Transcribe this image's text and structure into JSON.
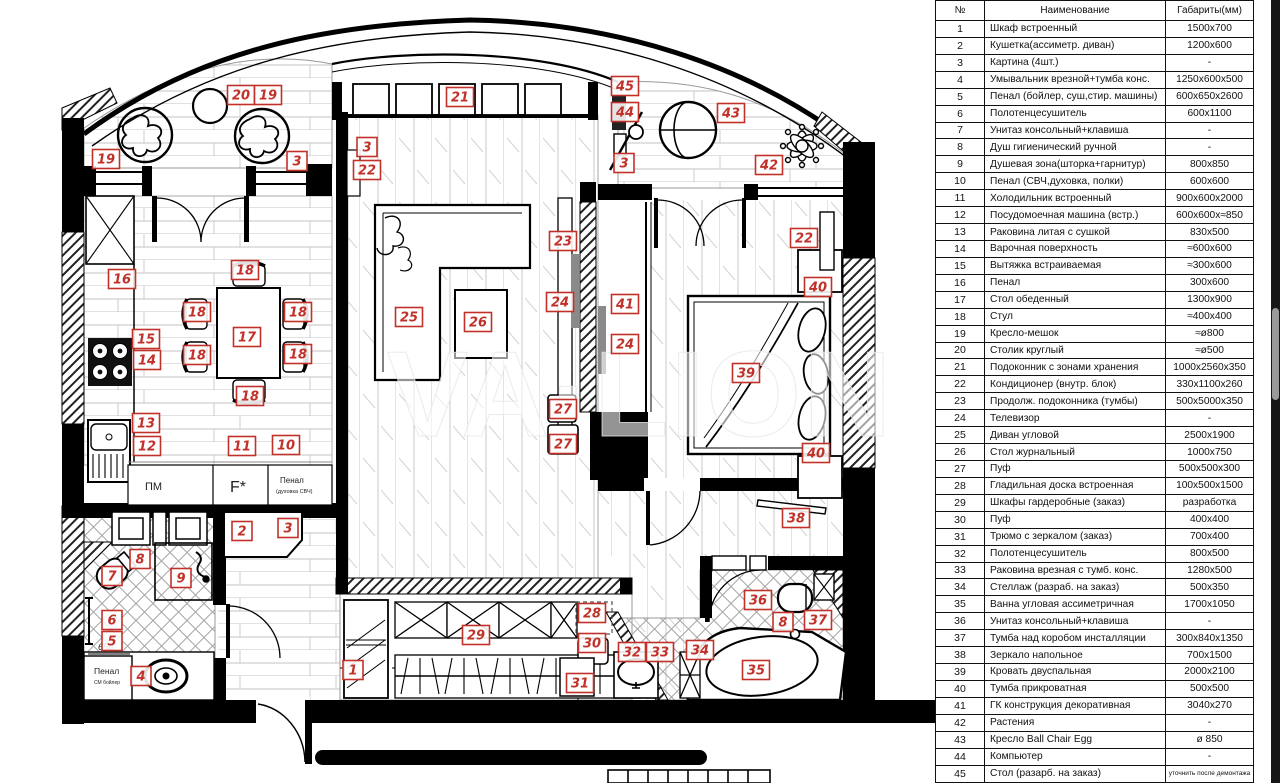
{
  "watermark": "VA·LION",
  "table": {
    "headers": [
      "№",
      "Наименование",
      "Габариты(мм)"
    ],
    "rows": [
      {
        "num": "1",
        "name": "Шкаф встроенный",
        "dim": "1500x700"
      },
      {
        "num": "2",
        "name": "Кушетка(ассиметр. диван)",
        "dim": "1200x600"
      },
      {
        "num": "3",
        "name": "Картина (4шт.)",
        "dim": "-"
      },
      {
        "num": "4",
        "name": "Умывальник врезной+тумба конс.",
        "dim": "1250x600x500"
      },
      {
        "num": "5",
        "name": "Пенал (бойлер, суш,стир. машины)",
        "dim": "600x650x2600"
      },
      {
        "num": "6",
        "name": "Полотенцесушитель",
        "dim": "600x1100"
      },
      {
        "num": "7",
        "name": "Унитаз консольный+клавиша",
        "dim": "-"
      },
      {
        "num": "8",
        "name": "Душ гигиенический ручной",
        "dim": "-"
      },
      {
        "num": "9",
        "name": "Душевая зона(шторка+гарнитур)",
        "dim": "800x850"
      },
      {
        "num": "10",
        "name": "Пенал (СВЧ,духовка, полки)",
        "dim": "600x600"
      },
      {
        "num": "11",
        "name": "Холодильник  встроенный",
        "dim": "900x600x2000"
      },
      {
        "num": "12",
        "name": "Посудомоечная машина (встр.)",
        "dim": "600x600x≈850"
      },
      {
        "num": "13",
        "name": "Раковина литая с сушкой",
        "dim": "830x500"
      },
      {
        "num": "14",
        "name": "Варочная поверхность",
        "dim": "≈600x600"
      },
      {
        "num": "15",
        "name": "Вытяжка встраиваемая",
        "dim": "≈300x600"
      },
      {
        "num": "16",
        "name": "Пенал",
        "dim": "300x600"
      },
      {
        "num": "17",
        "name": "Стол обеденный",
        "dim": "1300x900"
      },
      {
        "num": "18",
        "name": "Стул",
        "dim": "≈400x400"
      },
      {
        "num": "19",
        "name": "Кресло-мешок",
        "dim": "≈ø800"
      },
      {
        "num": "20",
        "name": "Столик круглый",
        "dim": "≈ø500"
      },
      {
        "num": "21",
        "name": "Подоконник с зонами хранения",
        "dim": "1000x2560x350"
      },
      {
        "num": "22",
        "name": "Кондиционер (внутр. блок)",
        "dim": "330x1100x260"
      },
      {
        "num": "23",
        "name": "Продолж. подоконника (тумбы)",
        "dim": "500x5000x350"
      },
      {
        "num": "24",
        "name": "Телевизор",
        "dim": "-"
      },
      {
        "num": "25",
        "name": "Диван угловой",
        "dim": "2500x1900"
      },
      {
        "num": "26",
        "name": "Стол журнальный",
        "dim": "1000x750"
      },
      {
        "num": "27",
        "name": "Пуф",
        "dim": "500x500x300"
      },
      {
        "num": "28",
        "name": "Гладильная доска встроенная",
        "dim": "100x500x1500"
      },
      {
        "num": "29",
        "name": "Шкафы гардеробные (заказ)",
        "dim": "разработка"
      },
      {
        "num": "30",
        "name": "Пуф",
        "dim": "400x400"
      },
      {
        "num": "31",
        "name": "Трюмо с зеркалом (заказ)",
        "dim": "700x400"
      },
      {
        "num": "32",
        "name": "Полотенцесушитель",
        "dim": "800x500"
      },
      {
        "num": "33",
        "name": "Раковина врезная с тумб. конс.",
        "dim": "1280x500"
      },
      {
        "num": "34",
        "name": "Стеллаж (разраб. на заказ)",
        "dim": "500x350"
      },
      {
        "num": "35",
        "name": "Ванна угловая ассиметричная",
        "dim": "1700x1050"
      },
      {
        "num": "36",
        "name": "Унитаз консольный+клавиша",
        "dim": "-"
      },
      {
        "num": "37",
        "name": "Тумба над коробом инсталляции",
        "dim": "300x840x1350"
      },
      {
        "num": "38",
        "name": "Зеркало напольное",
        "dim": "700x1500"
      },
      {
        "num": "39",
        "name": "Кровать двуспальная",
        "dim": "2000x2100"
      },
      {
        "num": "40",
        "name": "Тумба прикроватная",
        "dim": "500x500"
      },
      {
        "num": "41",
        "name": "ГК конструкция декоративная",
        "dim": "3040x270"
      },
      {
        "num": "42",
        "name": "Растения",
        "dim": "-"
      },
      {
        "num": "43",
        "name": "Кресло Ball Chair Egg",
        "dim": "ø 850"
      },
      {
        "num": "44",
        "name": "Компьютер",
        "dim": "-"
      },
      {
        "num": "45",
        "name": "Стол (разарб. на заказ)",
        "dim": "уточнить после демонтажа"
      }
    ]
  },
  "plan": {
    "labels": [
      {
        "n": "19",
        "x": 106,
        "y": 159
      },
      {
        "n": "20",
        "x": 241,
        "y": 95
      },
      {
        "n": "19",
        "x": 268,
        "y": 95
      },
      {
        "n": "3",
        "x": 297,
        "y": 161
      },
      {
        "n": "3",
        "x": 367,
        "y": 147
      },
      {
        "n": "22",
        "x": 367,
        "y": 170
      },
      {
        "n": "21",
        "x": 460,
        "y": 97
      },
      {
        "n": "45",
        "x": 625,
        "y": 86
      },
      {
        "n": "44",
        "x": 625,
        "y": 112
      },
      {
        "n": "3",
        "x": 624,
        "y": 163
      },
      {
        "n": "43",
        "x": 731,
        "y": 113
      },
      {
        "n": "42",
        "x": 769,
        "y": 165
      },
      {
        "n": "22",
        "x": 804,
        "y": 238
      },
      {
        "n": "23",
        "x": 563,
        "y": 241
      },
      {
        "n": "40",
        "x": 818,
        "y": 287
      },
      {
        "n": "16",
        "x": 122,
        "y": 279
      },
      {
        "n": "18",
        "x": 245,
        "y": 270
      },
      {
        "n": "18",
        "x": 197,
        "y": 312
      },
      {
        "n": "18",
        "x": 298,
        "y": 312
      },
      {
        "n": "17",
        "x": 247,
        "y": 337
      },
      {
        "n": "15",
        "x": 146,
        "y": 339
      },
      {
        "n": "14",
        "x": 147,
        "y": 360
      },
      {
        "n": "18",
        "x": 197,
        "y": 355
      },
      {
        "n": "18",
        "x": 298,
        "y": 354
      },
      {
        "n": "18",
        "x": 250,
        "y": 396
      },
      {
        "n": "13",
        "x": 146,
        "y": 423
      },
      {
        "n": "12",
        "x": 147,
        "y": 446
      },
      {
        "n": "11",
        "x": 242,
        "y": 446
      },
      {
        "n": "10",
        "x": 286,
        "y": 445
      },
      {
        "n": "25",
        "x": 409,
        "y": 317
      },
      {
        "n": "26",
        "x": 478,
        "y": 322
      },
      {
        "n": "24",
        "x": 560,
        "y": 302
      },
      {
        "n": "41",
        "x": 625,
        "y": 304
      },
      {
        "n": "24",
        "x": 625,
        "y": 344
      },
      {
        "n": "27",
        "x": 563,
        "y": 409
      },
      {
        "n": "27",
        "x": 563,
        "y": 444
      },
      {
        "n": "39",
        "x": 746,
        "y": 373
      },
      {
        "n": "40",
        "x": 816,
        "y": 453
      },
      {
        "n": "38",
        "x": 796,
        "y": 518
      },
      {
        "n": "2",
        "x": 242,
        "y": 531
      },
      {
        "n": "3",
        "x": 288,
        "y": 528
      },
      {
        "n": "8",
        "x": 140,
        "y": 559
      },
      {
        "n": "7",
        "x": 112,
        "y": 576
      },
      {
        "n": "9",
        "x": 181,
        "y": 578
      },
      {
        "n": "6",
        "x": 112,
        "y": 620
      },
      {
        "n": "5",
        "x": 112,
        "y": 641
      },
      {
        "n": "4",
        "x": 141,
        "y": 676
      },
      {
        "n": "1",
        "x": 353,
        "y": 670
      },
      {
        "n": "29",
        "x": 476,
        "y": 635
      },
      {
        "n": "28",
        "x": 592,
        "y": 613
      },
      {
        "n": "30",
        "x": 592,
        "y": 643
      },
      {
        "n": "31",
        "x": 580,
        "y": 683
      },
      {
        "n": "32",
        "x": 632,
        "y": 652
      },
      {
        "n": "33",
        "x": 660,
        "y": 652
      },
      {
        "n": "34",
        "x": 700,
        "y": 650
      },
      {
        "n": "36",
        "x": 758,
        "y": 600
      },
      {
        "n": "8",
        "x": 783,
        "y": 622
      },
      {
        "n": "37",
        "x": 818,
        "y": 620
      },
      {
        "n": "35",
        "x": 756,
        "y": 670
      }
    ],
    "texts": {
      "pm": "ПМ",
      "fridge": "F*",
      "penal_kitchen_1": "Пенал",
      "penal_kitchen_2": "(духовка СВЧ)",
      "penal_bath_1": "Пенал",
      "penal_bath_2": "СМ  бойлер",
      "dim650": "650"
    }
  }
}
